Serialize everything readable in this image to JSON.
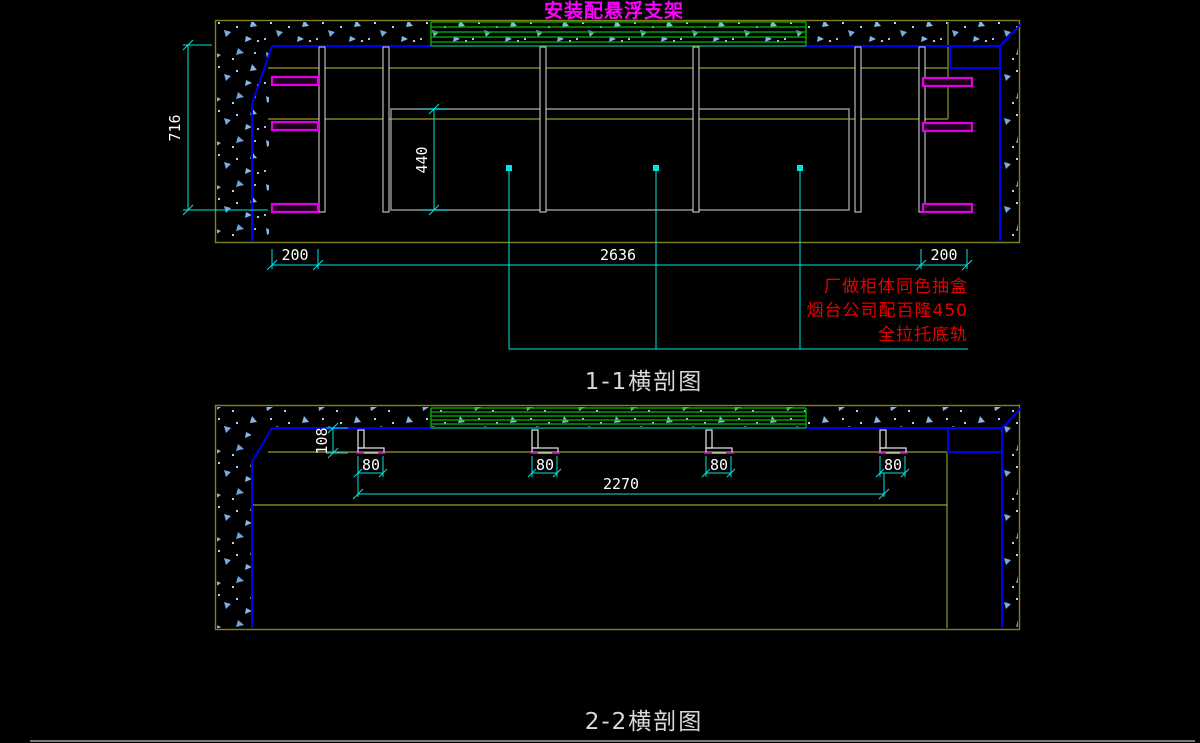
{
  "window": {
    "background": "#000000"
  },
  "colors": {
    "outline_olive": "#80801e",
    "wall_blue": "#0000f0",
    "shelf_band_green": "#00bb00",
    "bracket_magenta": "#e000e0",
    "dimension_cyan": "#00e5e5",
    "dimension_text_white": "#ffffff",
    "drawer_box_gray": "#9a9a9a",
    "note_red": "#e60000",
    "title_magenta": "#ff00ff",
    "hatch_speck_blue": "#86b7ea"
  },
  "title": "安装配悬浮支架",
  "section_1": {
    "caption": "1-1横剖图",
    "dimensions": {
      "overall_height": "716",
      "drawer_zone_height": "440",
      "left_gap": "200",
      "cabinet_span": "2636",
      "right_gap": "200"
    },
    "note": {
      "line1": "厂做柜体同色抽盒",
      "line2": "烟台公司配百隆450",
      "line3": "全拉托底轨"
    }
  },
  "section_2": {
    "caption": "2-2横剖图",
    "dimensions": {
      "bracket_drop": "108",
      "bracket_width": "80",
      "bracket_span": "2270"
    }
  }
}
